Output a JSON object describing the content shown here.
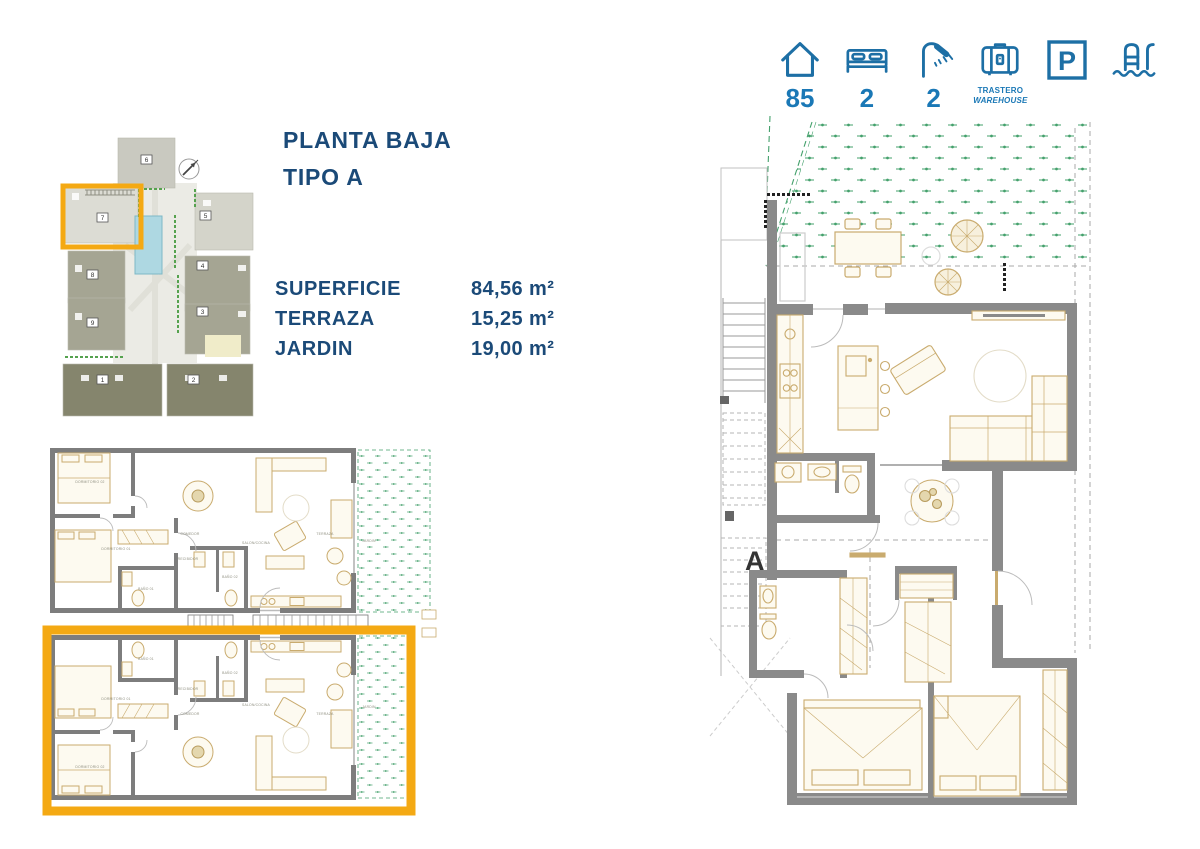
{
  "stats_bar": {
    "area_value": "85",
    "bedrooms_value": "2",
    "bathrooms_value": "2",
    "storage_line1": "TRASTERO",
    "storage_line2": "WAREHOUSE",
    "parking_letter": "P"
  },
  "plan_header": {
    "title_line1": "PLANTA BAJA",
    "title_line2": "TIPO A"
  },
  "areas_table": {
    "rows": [
      {
        "label": "SUPERFICIE",
        "value": "84,56 m²"
      },
      {
        "label": "TERRAZA",
        "value": "15,25 m²"
      },
      {
        "label": "JARDIN",
        "value": "19,00 m²"
      }
    ]
  },
  "site_plan": {
    "buildings": [
      "1",
      "2",
      "3",
      "4",
      "5",
      "6",
      "7",
      "8",
      "9"
    ],
    "highlighted_building": "7"
  },
  "small_plan": {
    "rooms": {
      "dormitorio_1": "DORMITORIO 01",
      "dormitorio_2": "DORMITORIO 02",
      "bano_1": "BAÑO 01",
      "bano_2": "BAÑO 02",
      "recibidor": "RECIBIDOR",
      "comedor": "COMEDOR",
      "salon_cocina": "SALON/COCINA",
      "terraza": "TERRAZA",
      "jardin": "JARDIN"
    }
  },
  "large_plan": {
    "section_label": "A"
  },
  "colors": {
    "icon_blue": "#1d6fa5",
    "number_blue": "#1a78b6",
    "title_navy": "#1b4a78",
    "highlight_yellow": "#f4a913",
    "wall_gray": "#8a8a8a",
    "furniture_tan": "#c9ab6e",
    "garden_green": "#43a06b"
  }
}
